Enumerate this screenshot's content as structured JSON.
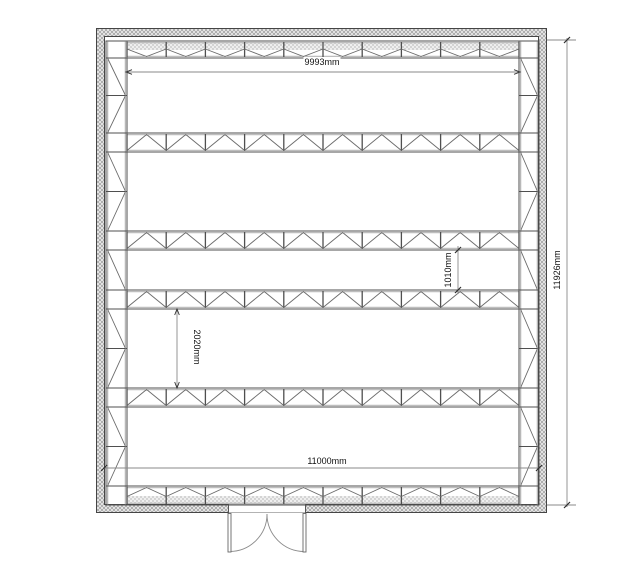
{
  "drawing": {
    "title": "storage room floor plan",
    "dimensions": {
      "top_span": "9993mm",
      "narrow_aisle": "1010mm",
      "wide_aisle": "2020mm",
      "interior_width": "11000mm",
      "overall_depth": "11926mm"
    },
    "colors": {
      "line": "#4f4f4f",
      "dimension_line": "#8a8a8a",
      "tick": "#2f2f2f",
      "wall_hatch": "#8f8f8f",
      "stipple": "#9a9a9a",
      "text": "#111111"
    }
  }
}
